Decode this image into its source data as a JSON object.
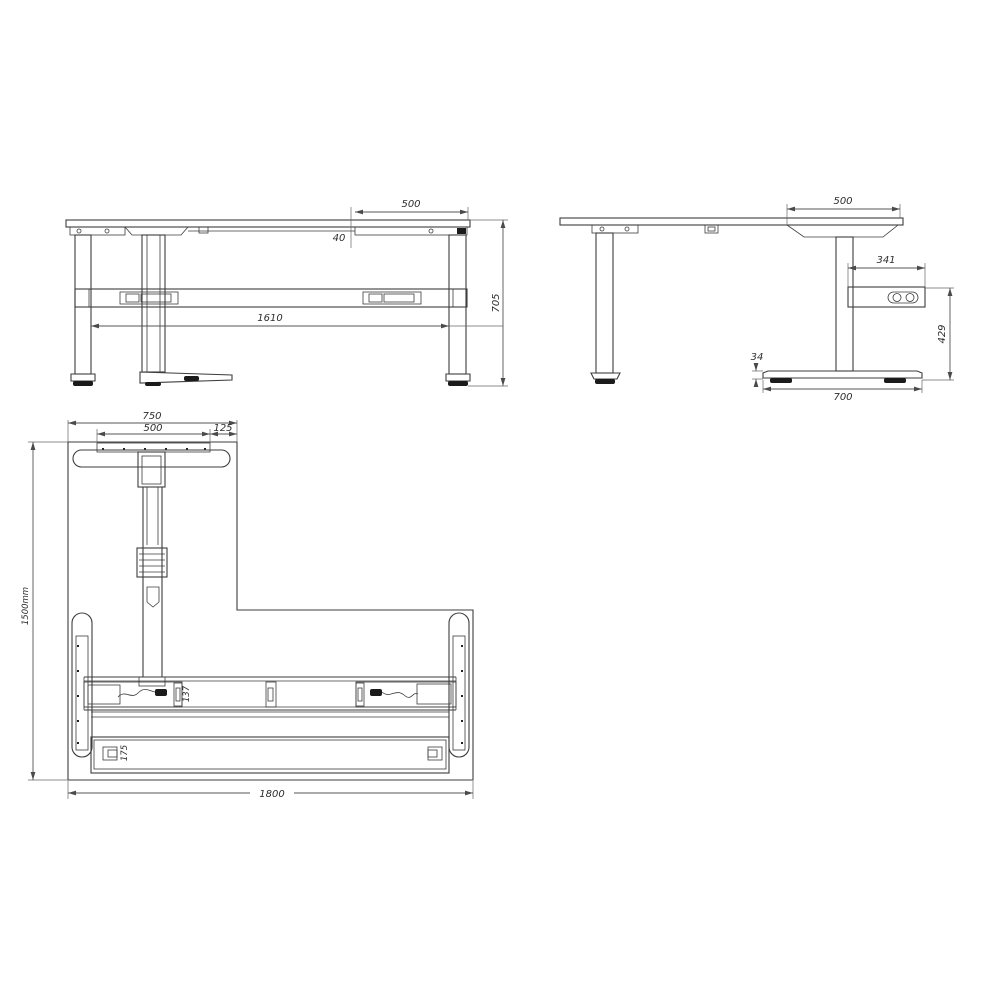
{
  "views": {
    "front": {
      "dims": {
        "top_right_segment": "500",
        "top_thickness": "40",
        "leg_span": "1610",
        "frame_height": "705"
      }
    },
    "side": {
      "dims": {
        "top_depth_segment": "500",
        "control_box_length": "341",
        "control_box_floor_height": "429",
        "foot_height": "34",
        "foot_length": "700"
      }
    },
    "plan": {
      "dims": {
        "return_width": "750",
        "mount_plate_width": "500",
        "side_offset": "125",
        "overall_depth": "1500mm",
        "overall_width": "1800",
        "beam_depth": "137",
        "rear_panel_depth": "175"
      }
    }
  }
}
